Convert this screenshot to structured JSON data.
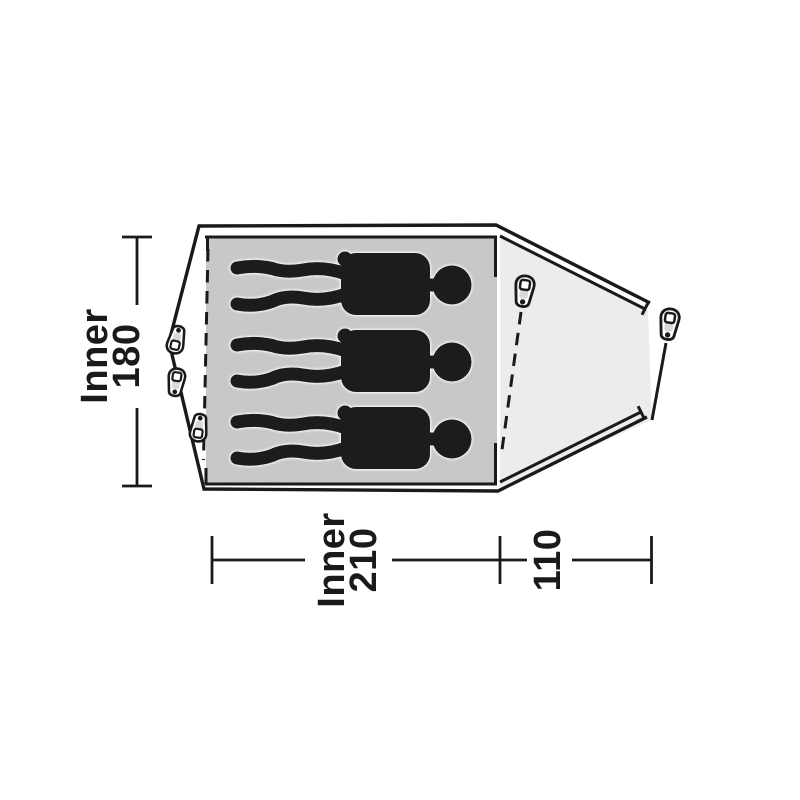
{
  "diagram": {
    "kind": "tent-floorplan-top-view",
    "labels": {
      "inner_depth": {
        "prefix": "Inner",
        "value": "180"
      },
      "inner_length": {
        "prefix": "Inner",
        "value": "210"
      },
      "porch_length": {
        "value": "110"
      }
    },
    "figures": {
      "count": 3
    },
    "pegs": {
      "count": 5
    }
  },
  "colors": {
    "line": "#1a1a1a",
    "figure": "#1c1c1c",
    "floor": "#c8c8c8",
    "vestibule": "#ececec",
    "peg_shade": "#d9d9d9",
    "background": "#ffffff"
  }
}
